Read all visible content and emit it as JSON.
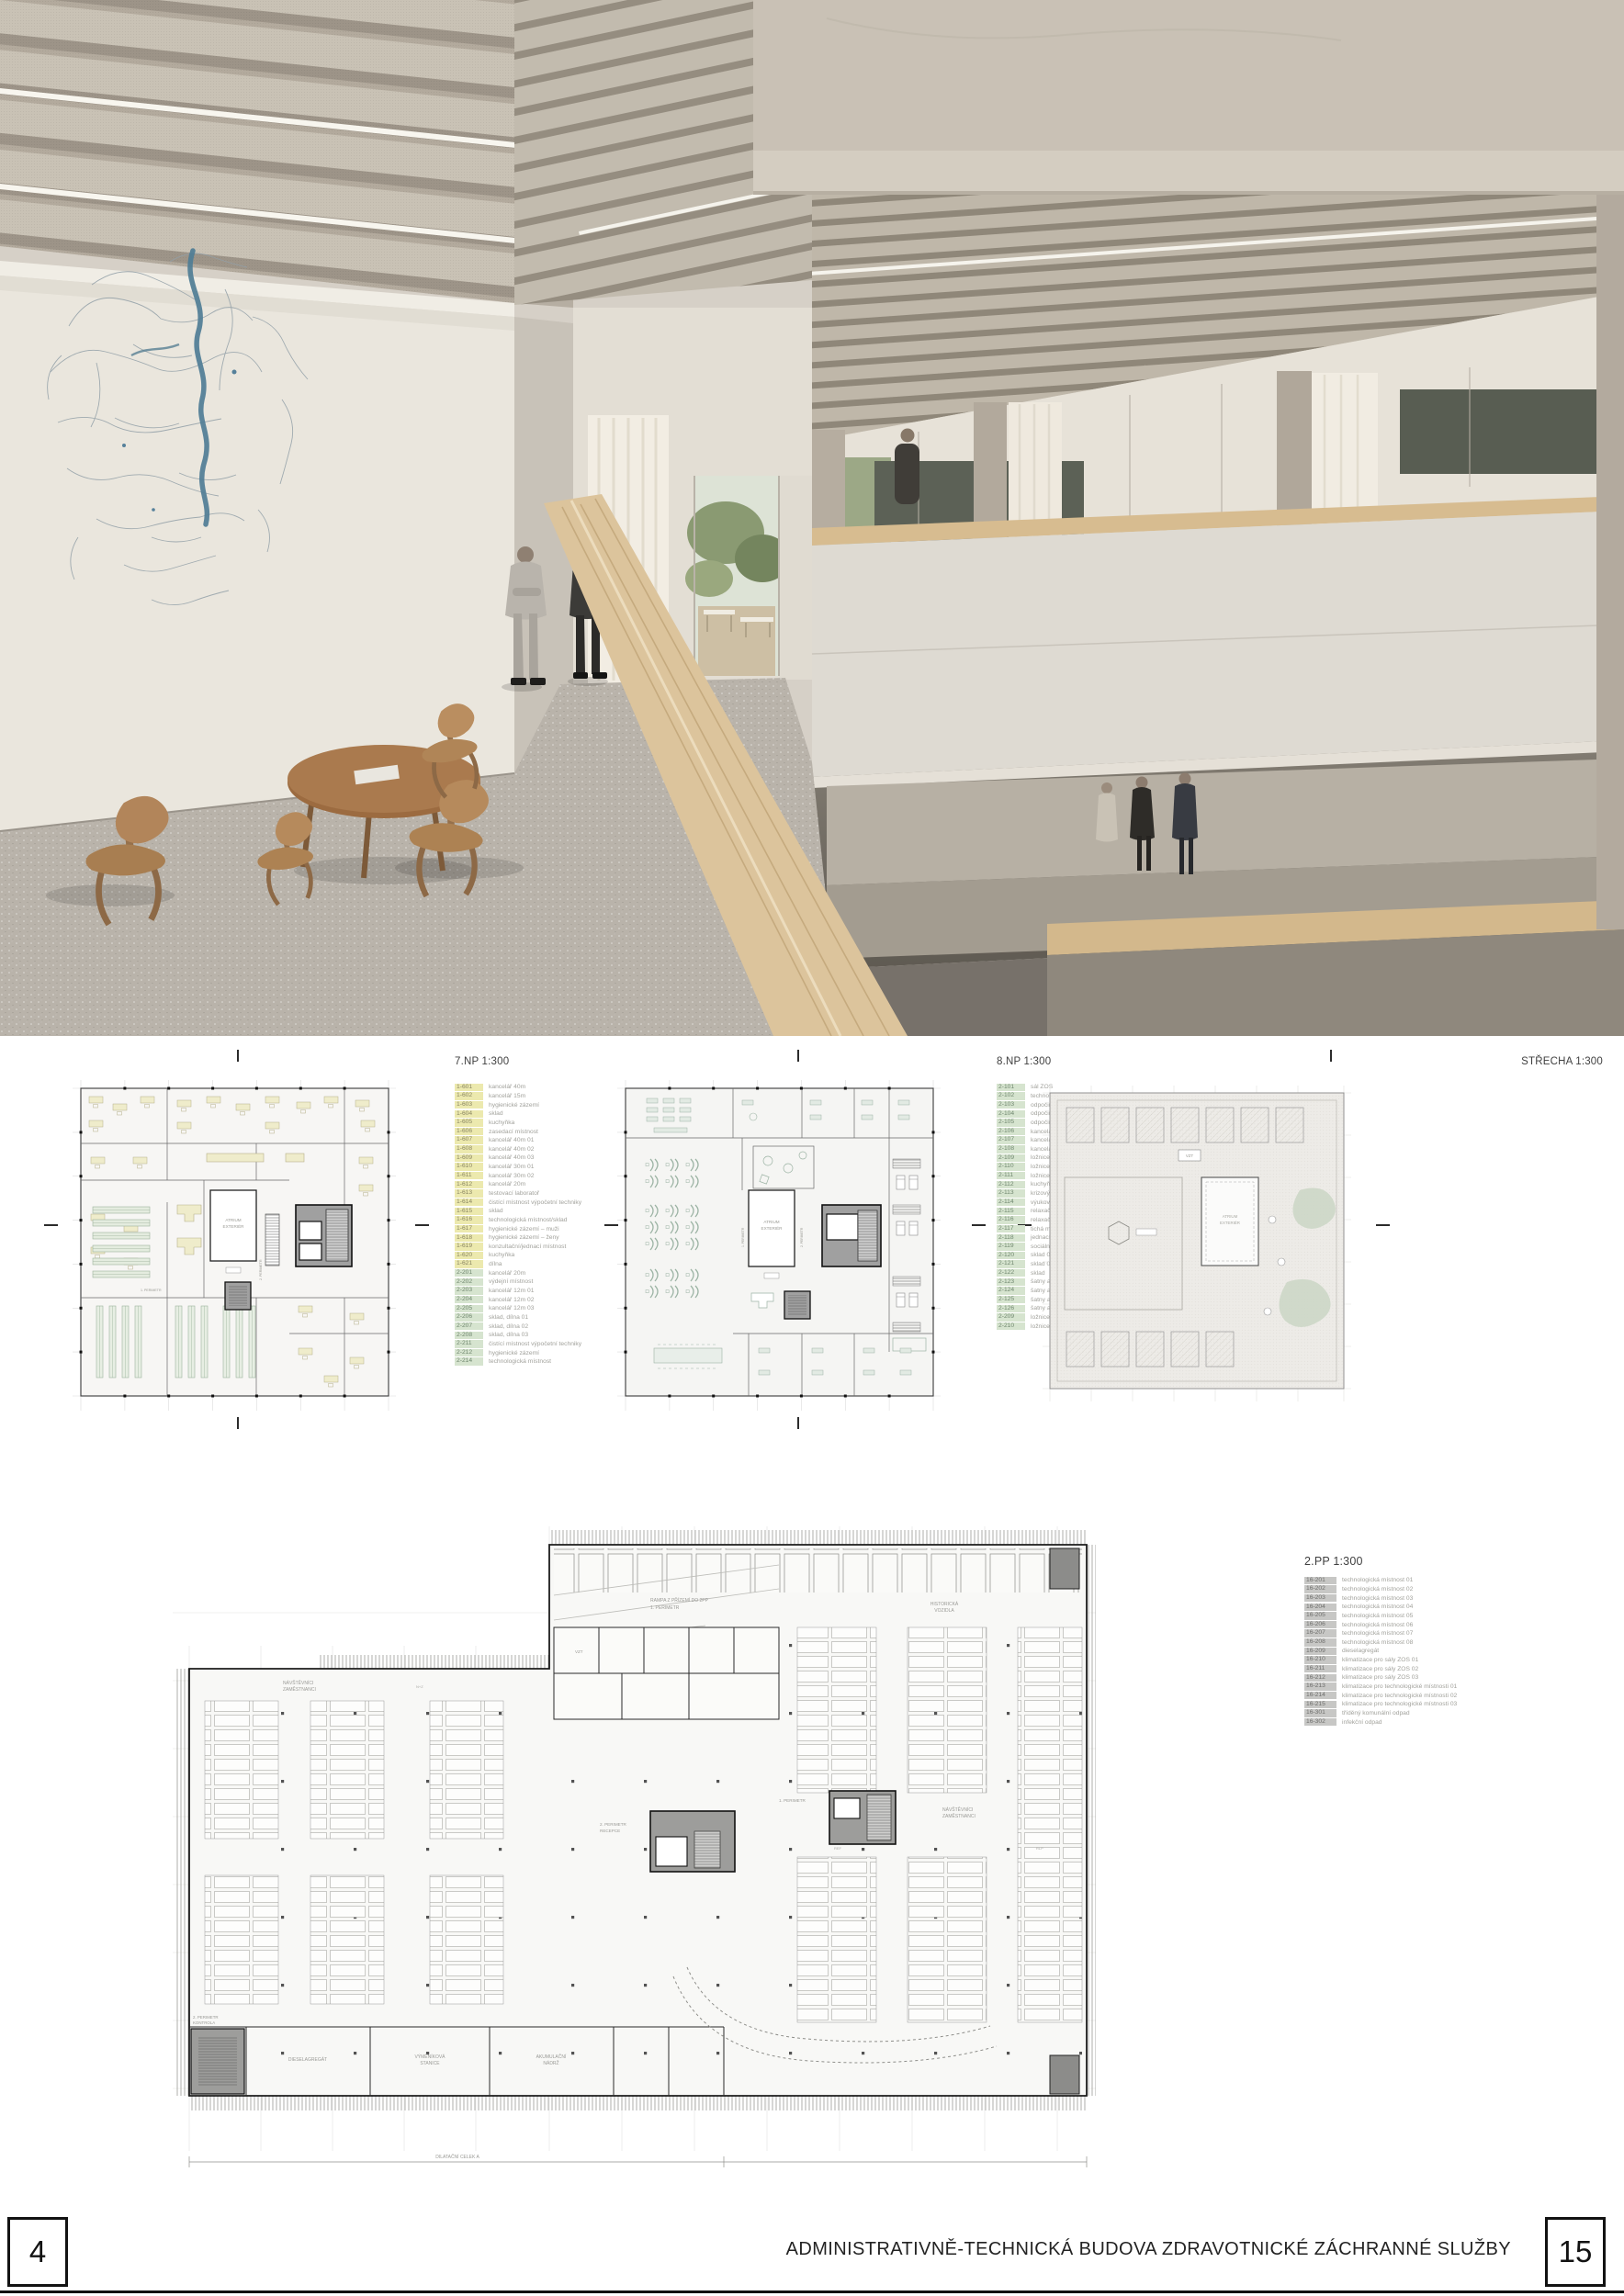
{
  "footer": {
    "page_left": "4",
    "page_right": "15",
    "title": "ADMINISTRATIVNĚ-TECHNICKÁ BUDOVA ZDRAVOTNICKÉ ZÁCHRANNÉ SLUŽBY"
  },
  "plans": {
    "np7": {
      "title": "7.NP 1:300",
      "legend": [
        {
          "code": "1-601",
          "label": "kancelář 40m",
          "group": "y"
        },
        {
          "code": "1-602",
          "label": "kancelář 15m",
          "group": "y"
        },
        {
          "code": "1-603",
          "label": "hygienické zázemí",
          "group": "y"
        },
        {
          "code": "1-604",
          "label": "sklad",
          "group": "y"
        },
        {
          "code": "1-605",
          "label": "kuchyňka",
          "group": "y"
        },
        {
          "code": "1-606",
          "label": "zasedací místnost",
          "group": "y"
        },
        {
          "code": "1-607",
          "label": "kancelář 40m 01",
          "group": "y"
        },
        {
          "code": "1-608",
          "label": "kancelář 40m 02",
          "group": "y"
        },
        {
          "code": "1-609",
          "label": "kancelář 40m 03",
          "group": "y"
        },
        {
          "code": "1-610",
          "label": "kancelář 30m 01",
          "group": "y"
        },
        {
          "code": "1-611",
          "label": "kancelář 30m 02",
          "group": "y"
        },
        {
          "code": "1-612",
          "label": "kancelář 20m",
          "group": "y"
        },
        {
          "code": "1-613",
          "label": "testovací laboratoř",
          "group": "y"
        },
        {
          "code": "1-614",
          "label": "čistící místnost výpočetní techniky",
          "group": "y"
        },
        {
          "code": "1-615",
          "label": "sklad",
          "group": "y"
        },
        {
          "code": "1-616",
          "label": "technologická místnost/sklad",
          "group": "y"
        },
        {
          "code": "1-617",
          "label": "hygienické zázemí – muži",
          "group": "y"
        },
        {
          "code": "1-618",
          "label": "hygienické zázemí – ženy",
          "group": "y"
        },
        {
          "code": "1-619",
          "label": "konzultační/jednací místnost",
          "group": "y"
        },
        {
          "code": "1-620",
          "label": "kuchyňka",
          "group": "y"
        },
        {
          "code": "1-621",
          "label": "dílna",
          "group": "y"
        },
        {
          "code": "2-201",
          "label": "kancelář 20m",
          "group": "g"
        },
        {
          "code": "2-202",
          "label": "výdejní místnost",
          "group": "g"
        },
        {
          "code": "2-203",
          "label": "kancelář 12m 01",
          "group": "g"
        },
        {
          "code": "2-204",
          "label": "kancelář 12m 02",
          "group": "g"
        },
        {
          "code": "2-205",
          "label": "kancelář 12m 03",
          "group": "g"
        },
        {
          "code": "2-206",
          "label": "sklad, dílna 01",
          "group": "g"
        },
        {
          "code": "2-207",
          "label": "sklad, dílna 02",
          "group": "g"
        },
        {
          "code": "2-208",
          "label": "sklad, dílna 03",
          "group": "g"
        },
        {
          "code": "2-211",
          "label": "čistící místnost výpočetní techniky",
          "group": "g"
        },
        {
          "code": "2-212",
          "label": "hygienické zázemí",
          "group": "g"
        },
        {
          "code": "2-214",
          "label": "technologická místnost",
          "group": "g"
        }
      ]
    },
    "np8": {
      "title": "8.NP 1:300",
      "legend": [
        {
          "code": "2-101",
          "label": "sál ZOS",
          "group": "g"
        },
        {
          "code": "2-102",
          "label": "technologický prostor",
          "group": "g"
        },
        {
          "code": "2-103",
          "label": "odpočinková místnost 24/7 01",
          "group": "g"
        },
        {
          "code": "2-104",
          "label": "odpočinková místnost 24/7 02",
          "group": "g"
        },
        {
          "code": "2-105",
          "label": "odpočinková místnost 24/7 03",
          "group": "g"
        },
        {
          "code": "2-106",
          "label": "kancelář vedení 25m 01",
          "group": "g"
        },
        {
          "code": "2-107",
          "label": "kancelář vedení 25m 02",
          "group": "g"
        },
        {
          "code": "2-108",
          "label": "kancelář vedení 25m 03",
          "group": "g"
        },
        {
          "code": "2-109",
          "label": "ložnice 01",
          "group": "g"
        },
        {
          "code": "2-110",
          "label": "ložnice 02",
          "group": "g"
        },
        {
          "code": "2-111",
          "label": "ložnice 03",
          "group": "g"
        },
        {
          "code": "2-112",
          "label": "kuchyňka+jídelna",
          "group": "g"
        },
        {
          "code": "2-113",
          "label": "krizový sál",
          "group": "g"
        },
        {
          "code": "2-114",
          "label": "výukový sál ZOS",
          "group": "g"
        },
        {
          "code": "2-115",
          "label": "relaxační místnost 01",
          "group": "g"
        },
        {
          "code": "2-116",
          "label": "relaxační místnost 02",
          "group": "g"
        },
        {
          "code": "2-117",
          "label": "tichá místnost",
          "group": "g"
        },
        {
          "code": "2-118",
          "label": "jednací místnost",
          "group": "g"
        },
        {
          "code": "2-119",
          "label": "sociální zázemí",
          "group": "g"
        },
        {
          "code": "2-120",
          "label": "sklad 01",
          "group": "g"
        },
        {
          "code": "2-121",
          "label": "sklad 02",
          "group": "g"
        },
        {
          "code": "2-122",
          "label": "sklad",
          "group": "g"
        },
        {
          "code": "2-123",
          "label": "šatny a sociální zázemí 01",
          "group": "g"
        },
        {
          "code": "2-124",
          "label": "šatny a sociální zázemí 02",
          "group": "g"
        },
        {
          "code": "2-125",
          "label": "šatny a sociální zázemí 03",
          "group": "g"
        },
        {
          "code": "2-126",
          "label": "šatny a sociální zázemí 04",
          "group": "g"
        },
        {
          "code": "2-209",
          "label": "ložnice 01",
          "group": "g"
        },
        {
          "code": "2-210",
          "label": "ložnice 02",
          "group": "g"
        }
      ]
    },
    "roof": {
      "title": "STŘECHA 1:300"
    },
    "pp2": {
      "title": "2.PP 1:300",
      "legend": [
        {
          "code": "16-201",
          "label": "technologická místnost 01",
          "group": "gr"
        },
        {
          "code": "16-202",
          "label": "technologická místnost 02",
          "group": "gr"
        },
        {
          "code": "16-203",
          "label": "technologická místnost 03",
          "group": "gr"
        },
        {
          "code": "16-204",
          "label": "technologická místnost 04",
          "group": "gr"
        },
        {
          "code": "16-205",
          "label": "technologická místnost 05",
          "group": "gr"
        },
        {
          "code": "16-206",
          "label": "technologická místnost 06",
          "group": "gr"
        },
        {
          "code": "16-207",
          "label": "technologická místnost 07",
          "group": "gr"
        },
        {
          "code": "16-208",
          "label": "technologická místnost 08",
          "group": "gr"
        },
        {
          "code": "16-209",
          "label": "dieselagregát",
          "group": "gr"
        },
        {
          "code": "16-210",
          "label": "klimatizace pro sály ZOS 01",
          "group": "gr"
        },
        {
          "code": "16-211",
          "label": "klimatizace pro sály ZOS 02",
          "group": "gr"
        },
        {
          "code": "16-212",
          "label": "klimatizace pro sály ZOS 03",
          "group": "gr"
        },
        {
          "code": "16-213",
          "label": "klimatizace pro technologické místnosti 01",
          "group": "gr"
        },
        {
          "code": "16-214",
          "label": "klimatizace pro technologické místnosti 02",
          "group": "gr"
        },
        {
          "code": "16-215",
          "label": "klimatizace pro technologické místnosti 03",
          "group": "gr"
        },
        {
          "code": "16-301",
          "label": "tříděný komunální odpad",
          "group": "gr"
        },
        {
          "code": "16-302",
          "label": "infekční odpad",
          "group": "gr"
        }
      ]
    }
  },
  "plan_labels": {
    "atrium_l1": "ATRIUM",
    "atrium_l2": "EXTERIÉR",
    "perimetr1": "1. PERIMETR",
    "perimetr2": "2. PERIMETR",
    "vzt": "VZT",
    "visitors_l1": "NÁVŠTĚVNÍCI",
    "visitors_l2": "ZAMĚSTNANCI",
    "historic_l1": "HISTORICKÁ",
    "historic_l2": "VOZIDLA",
    "diesel": "DIESELAGREGÁT",
    "exchanger_l1": "VÝMĚNÍKOVÁ",
    "exchanger_l2": "STANICE",
    "tank_l1": "AKUMULAČNÍ",
    "tank_l2": "NÁDRŽ",
    "ramp_l1": "RAMPA Z PŘÍZEMÍ DO 2PP",
    "ramp_l2": "1. PERIMETR",
    "recepce_l1": "2. PERIMETR",
    "recepce_l2": "RECEPCE",
    "kontrola_l1": "2. PERIMETR",
    "kontrola_l2": "KONTROLA",
    "dilatace": "DILATAČNÍ CELEK A",
    "stall_nz": "N+Z",
    "stall_ref": "REF",
    "stall_rlp": "RLP"
  }
}
